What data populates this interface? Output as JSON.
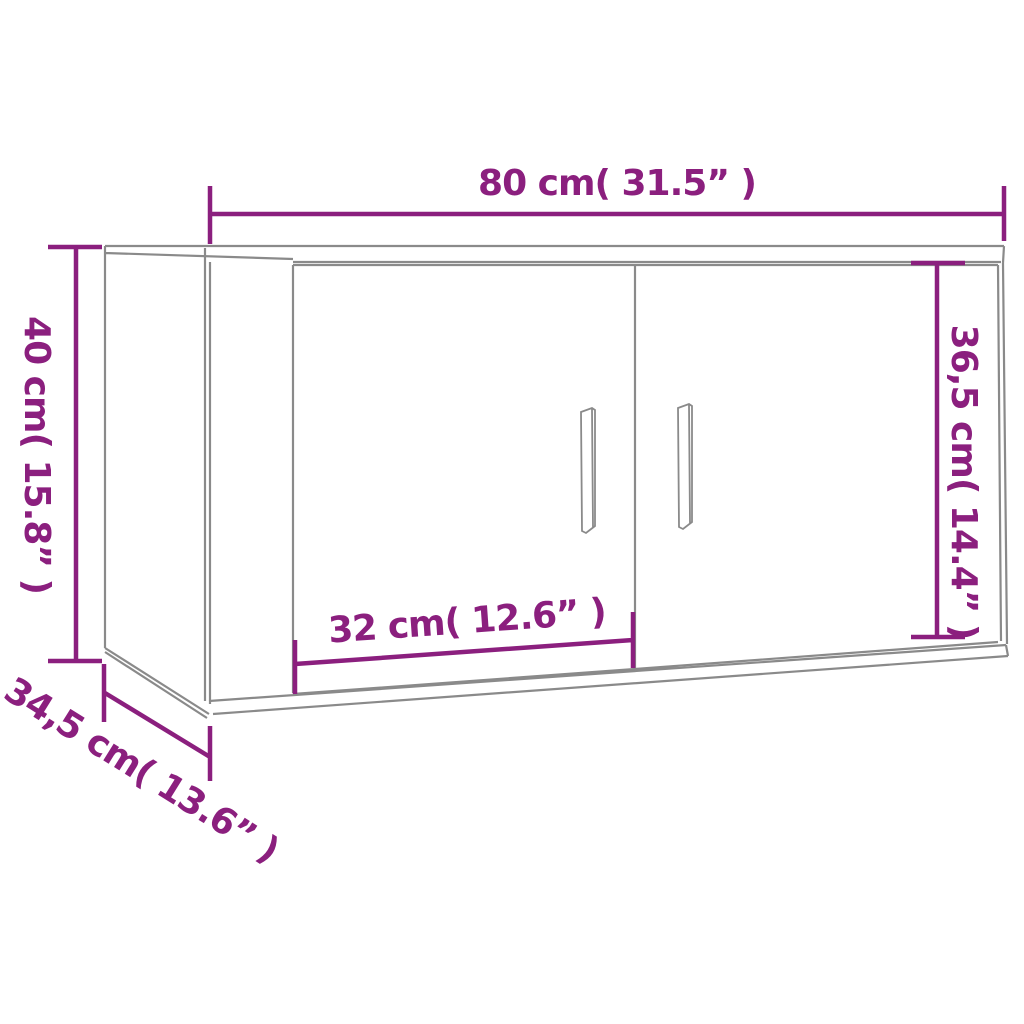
{
  "diagram": {
    "type": "furniture-dimension-drawing",
    "labels": {
      "width": "80 cm( 31.5” )",
      "height": "40 cm( 15.8” )",
      "door_height": "36,5 cm( 14.4” )",
      "door_width": "32 cm( 12.6” )",
      "depth": "34,5 cm( 13.6” )"
    },
    "values": {
      "width_cm": 80,
      "width_in": 31.5,
      "height_cm": 40,
      "height_in": 15.8,
      "door_height_cm": 36.5,
      "door_height_in": 14.4,
      "door_width_cm": 32,
      "door_width_in": 12.6,
      "depth_cm": 34.5,
      "depth_in": 13.6
    },
    "colors": {
      "dimension": "#8b1f7e",
      "drawing": "#8a8a8a",
      "background": "#ffffff"
    }
  }
}
